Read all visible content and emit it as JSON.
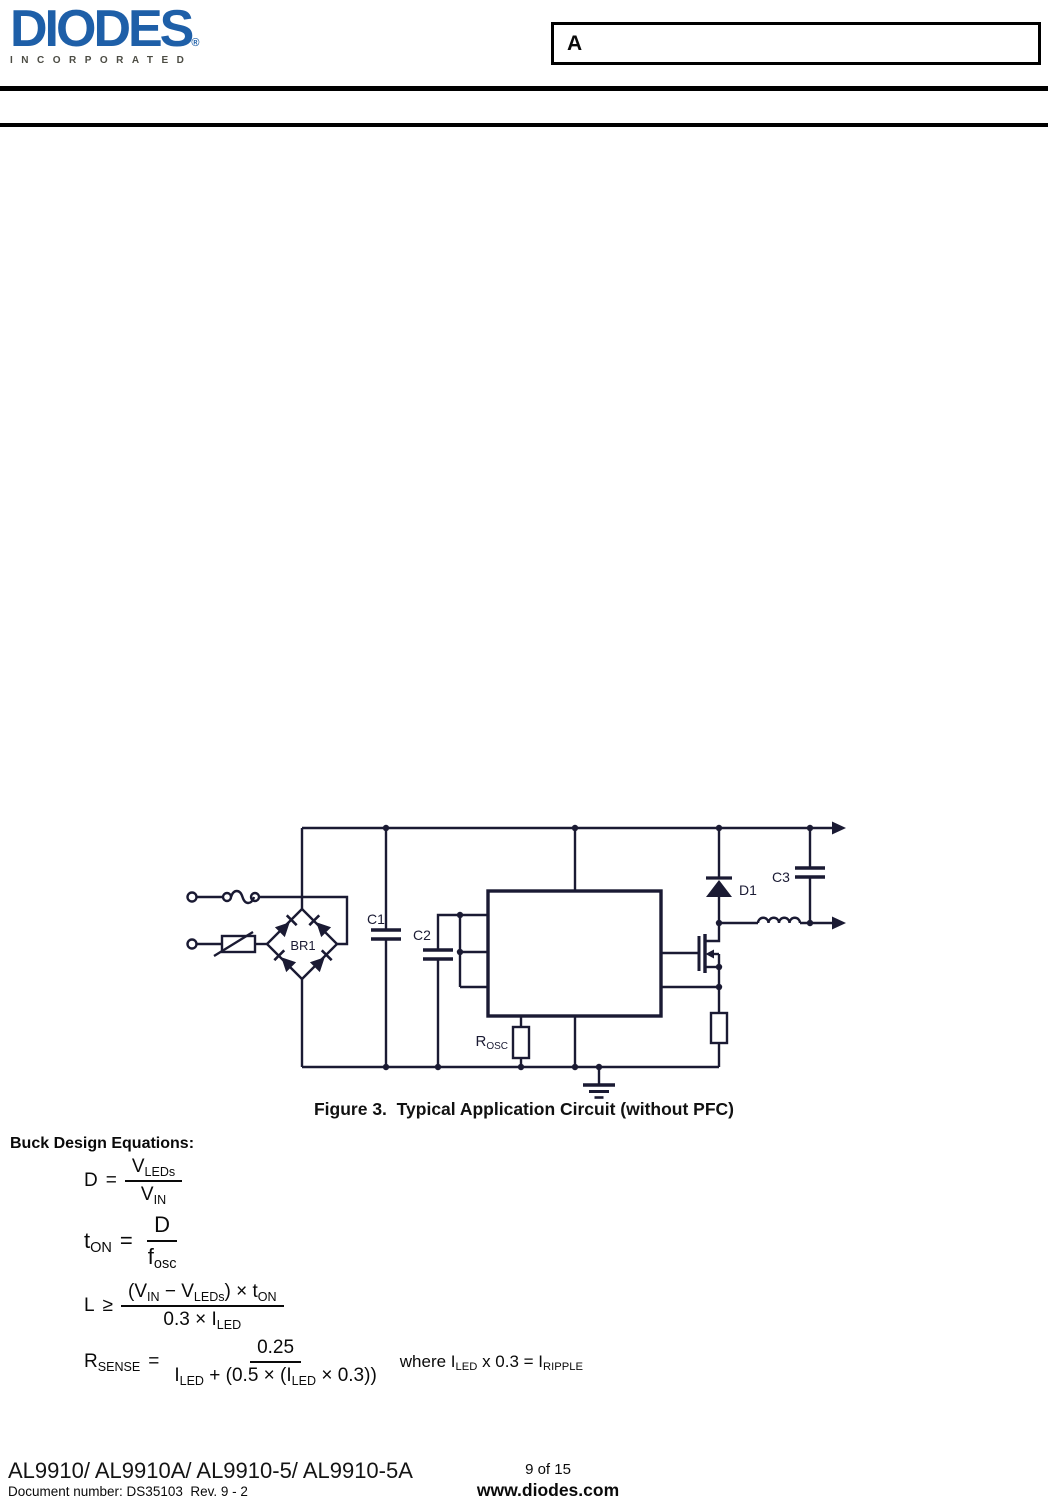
{
  "colors": {
    "logo_blue": "#1e5fa8",
    "tagline_gray": "#4c4c44",
    "line_dark": "#1a1a33"
  },
  "header": {
    "logo_word": "DIODES",
    "logo_reg": "®",
    "logo_tagline": "INCORPORATED",
    "revision_label": "A"
  },
  "circuit": {
    "bridge_label": "BR1",
    "c1_label": "C1",
    "c2_label": "C2",
    "c3_label": "C3",
    "d1_label": "D1",
    "rosc_base": "R",
    "rosc_sub": "OSC",
    "caption": "Figure 3.  Typical Application Circuit (without PFC)"
  },
  "equations": {
    "heading": "Buck Design Equations:",
    "list": [
      {
        "lhs": [
          {
            "t": "D"
          }
        ],
        "rel": "=",
        "num": [
          {
            "t": "V"
          },
          {
            "t": "LEDs",
            "sub": true
          }
        ],
        "den": [
          {
            "t": "V"
          },
          {
            "t": "IN",
            "sub": true
          }
        ]
      },
      {
        "lhs": [
          {
            "t": "t"
          },
          {
            "t": "ON",
            "sub": true
          }
        ],
        "rel": "=",
        "num": [
          {
            "t": "D"
          }
        ],
        "den": [
          {
            "t": "f"
          },
          {
            "t": "osc",
            "sub": true
          }
        ]
      },
      {
        "lhs": [
          {
            "t": "L"
          }
        ],
        "rel": "≥",
        "num": [
          {
            "t": "(V"
          },
          {
            "t": "IN",
            "sub": true
          },
          {
            "t": " − V"
          },
          {
            "t": "LEDs",
            "sub": true
          },
          {
            "t": ") × t"
          },
          {
            "t": "ON",
            "sub": true
          }
        ],
        "den": [
          {
            "t": "0.3 × I"
          },
          {
            "t": "LED",
            "sub": true
          }
        ]
      },
      {
        "lhs": [
          {
            "t": "R"
          },
          {
            "t": "SENSE",
            "sub": true
          }
        ],
        "rel": "=",
        "num": [
          {
            "t": "0.25"
          }
        ],
        "den": [
          {
            "t": "I"
          },
          {
            "t": "LED",
            "sub": true
          },
          {
            "t": " + (0.5 × (I"
          },
          {
            "t": "LED",
            "sub": true
          },
          {
            "t": " × 0.3))"
          }
        ],
        "note": [
          {
            "t": "where I"
          },
          {
            "t": "LED",
            "sub": true
          },
          {
            "t": " x 0.3 = I"
          },
          {
            "t": "RIPPLE",
            "sub": true
          }
        ]
      }
    ]
  },
  "footer": {
    "part_numbers": "AL9910/ AL9910A/ AL9910-5/ AL9910-5A",
    "document_number": "Document number: DS35103  Rev. 9 - 2",
    "page_indicator": "9 of 15",
    "website": "www.diodes.com"
  }
}
